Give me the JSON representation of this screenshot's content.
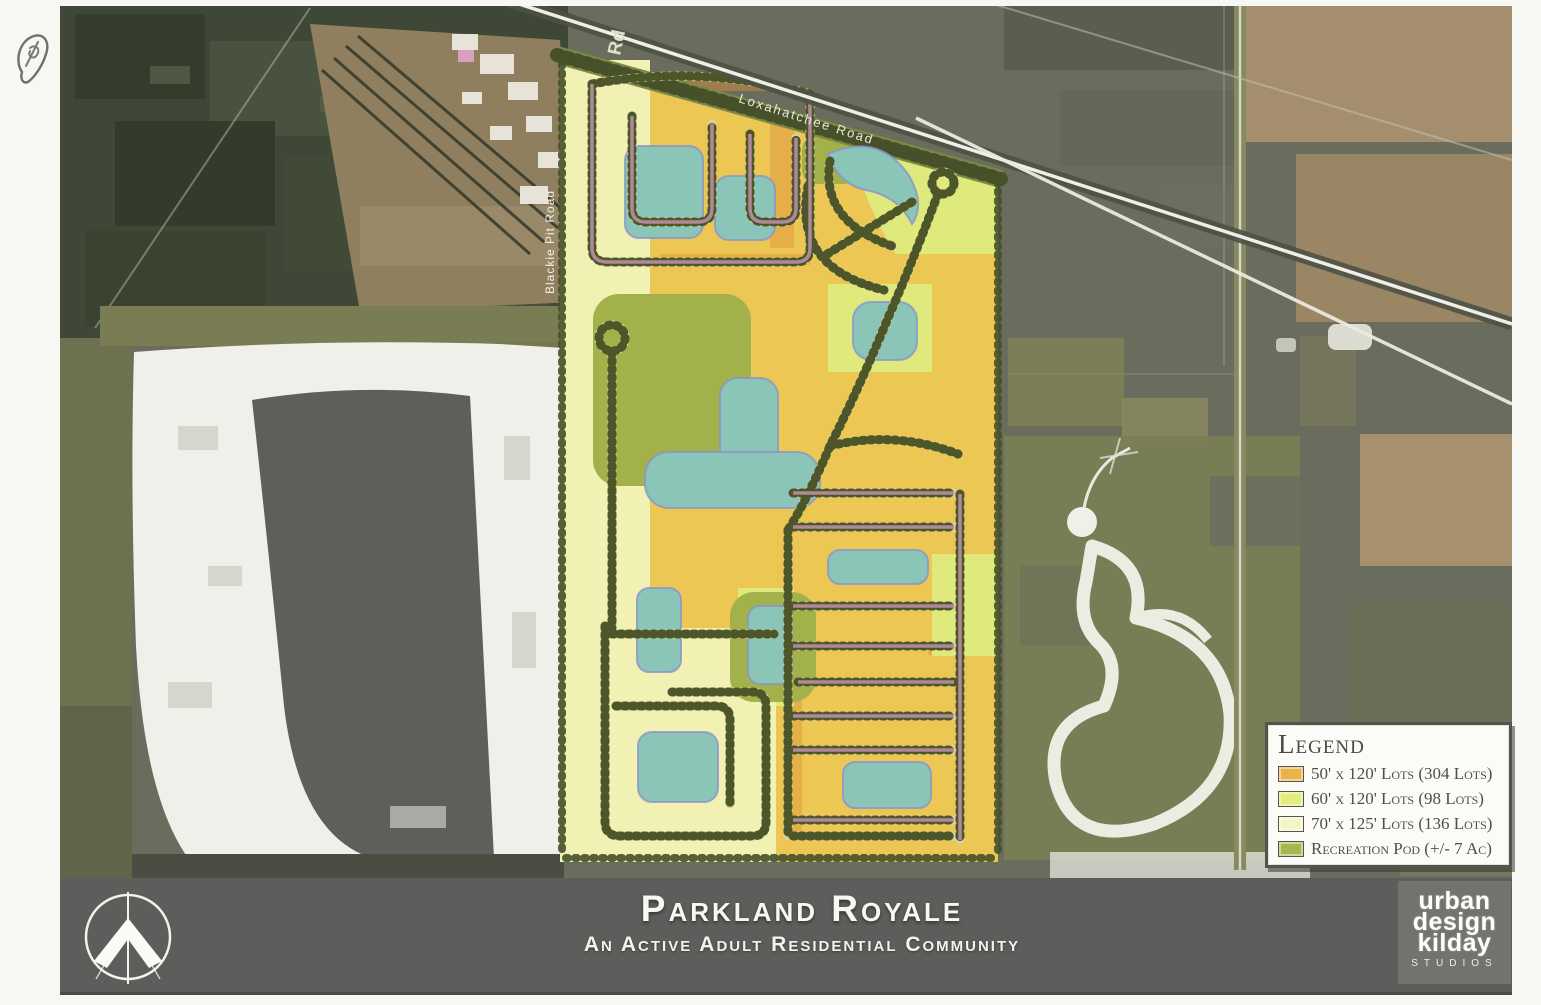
{
  "map": {
    "road_labels": {
      "diagonal": "Loxahatchee Road",
      "west": "Blackie Pit Road",
      "top": "Rd"
    },
    "colors": {
      "aerial_base": "#6a6d5e",
      "lot_50": "#ecc753",
      "lot_60": "#dfe97c",
      "lot_70": "#f0f1b2",
      "recreation": "#a3b14a",
      "lake": "#8ac5b8",
      "street_trees": "#4c5628",
      "street_accent": "#bb8fa4",
      "boundary_band": "#7d8746",
      "sand": "#f0f0ea",
      "water_pit": "#5d605a"
    }
  },
  "legend": {
    "title": "Legend",
    "rows": [
      {
        "label": "50' x 120' Lots (304 Lots)",
        "color": "#eab24b"
      },
      {
        "label": "60' x 120' Lots (98 Lots)",
        "color": "#e3ec7d"
      },
      {
        "label": "70' x 125' Lots (136 Lots)",
        "color": "#f3f5c6"
      },
      {
        "label": "Recreation Pod (+/- 7 Ac)",
        "color": "#a6b74f"
      }
    ]
  },
  "footer": {
    "title": "Parkland Royale",
    "subtitle": "An Active Adult Residential Community",
    "logo_lines": [
      "urban",
      "design",
      "kilday",
      "studios"
    ]
  }
}
